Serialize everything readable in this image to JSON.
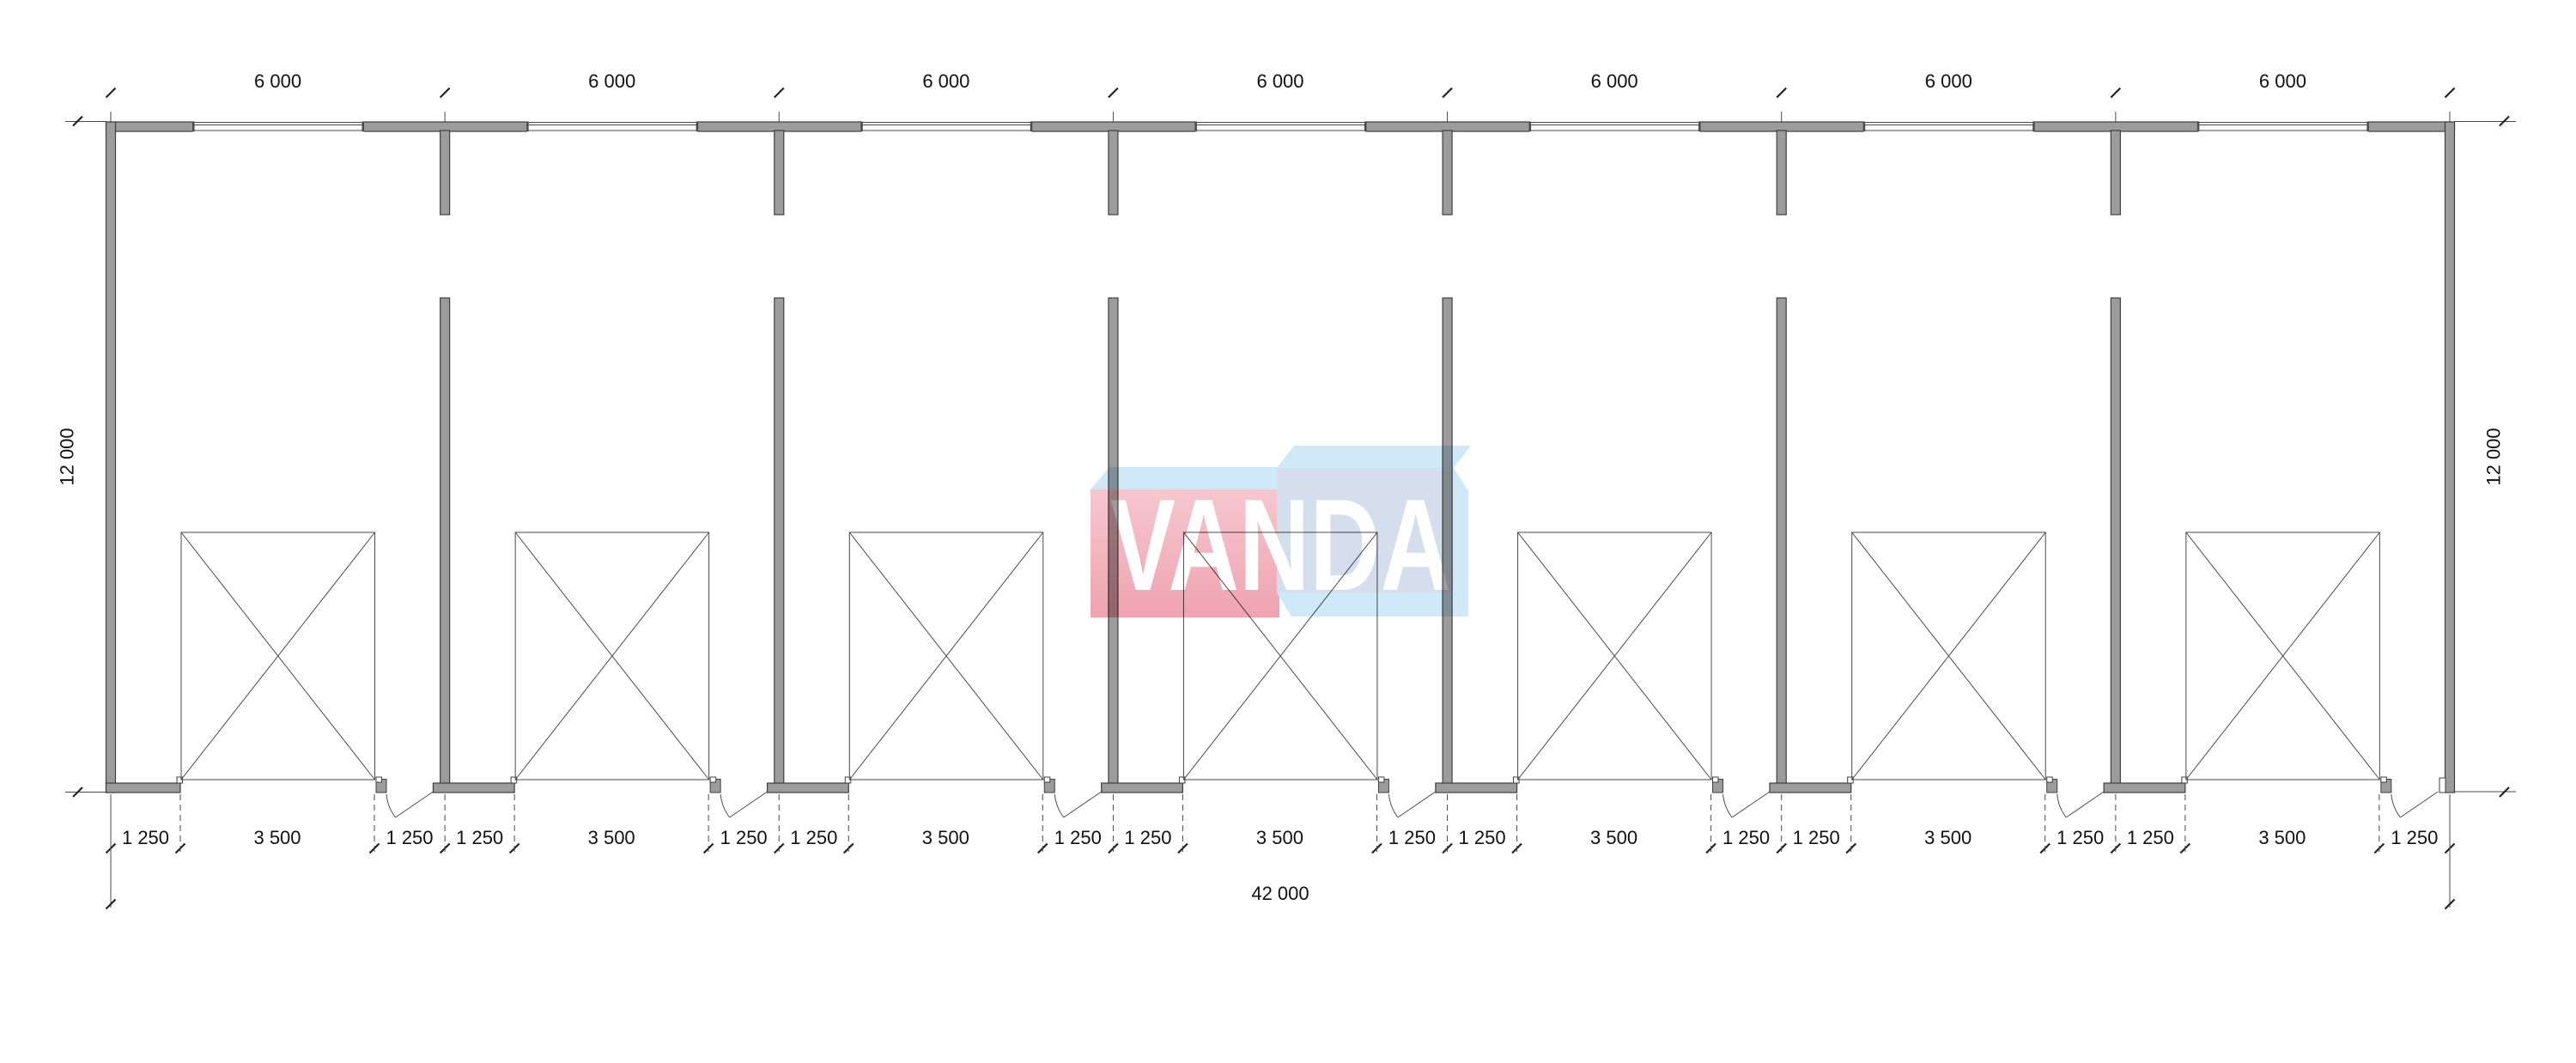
{
  "plan": {
    "bay_count": 7,
    "top_dim_labels": [
      "6 000",
      "6 000",
      "6 000",
      "6 000",
      "6 000",
      "6 000",
      "6 000"
    ],
    "left_dim_label": "12 000",
    "right_dim_label": "12 000",
    "bay_bottom_labels": [
      "1 250",
      "3 500",
      "1 250"
    ],
    "overall_dim_label": "42 000",
    "building_width_mm": 42000,
    "building_depth_mm": 12000,
    "bay_width_mm": 6000,
    "garage_opening_width_mm": 3500,
    "side_offset_mm": 1250
  },
  "logo": {
    "text": "VANDA",
    "colors": {
      "sky_top": "#cfe9f8",
      "pink_light": "#f6c7cf",
      "pink_deep": "#efa3b0",
      "slate_front": "#d4deec",
      "letters": "#ffffff"
    }
  },
  "colors": {
    "background": "#ffffff",
    "wall_fill": "#9c9c9c",
    "wall_stroke": "#3f3f3f",
    "thin_line": "#4a4a4a",
    "dim_line": "#333333",
    "tick": "#222222",
    "text": "#111111"
  }
}
